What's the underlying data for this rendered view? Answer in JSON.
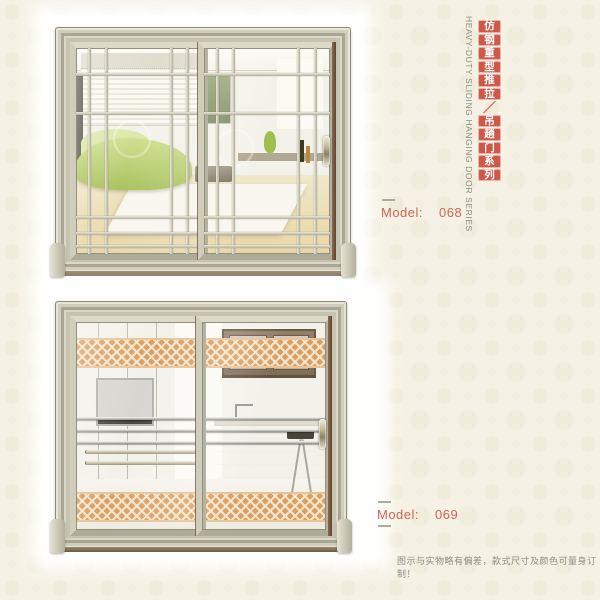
{
  "colors": {
    "page_bg": "#f5f2e5",
    "accent_red": "#cf5949",
    "model_text": "#d26352",
    "frame_champagne": "#c6c3b1",
    "fret_band": "#d9a066"
  },
  "side_title": {
    "english": "HEAVY-DUTY SLIDING HANGING DOOR SERIES",
    "chinese_chars": [
      "仿",
      "钢",
      "重",
      "型",
      "推",
      "拉",
      "／",
      "吊",
      "趟",
      "门",
      "系",
      "列"
    ]
  },
  "products": [
    {
      "model_label": "Model:",
      "model_number": "068"
    },
    {
      "model_label": "Model:",
      "model_number": "069"
    }
  ],
  "footer": {
    "disclaimer": "图示与实物略有偏差，款式尺寸及颜色可量身订制！"
  }
}
